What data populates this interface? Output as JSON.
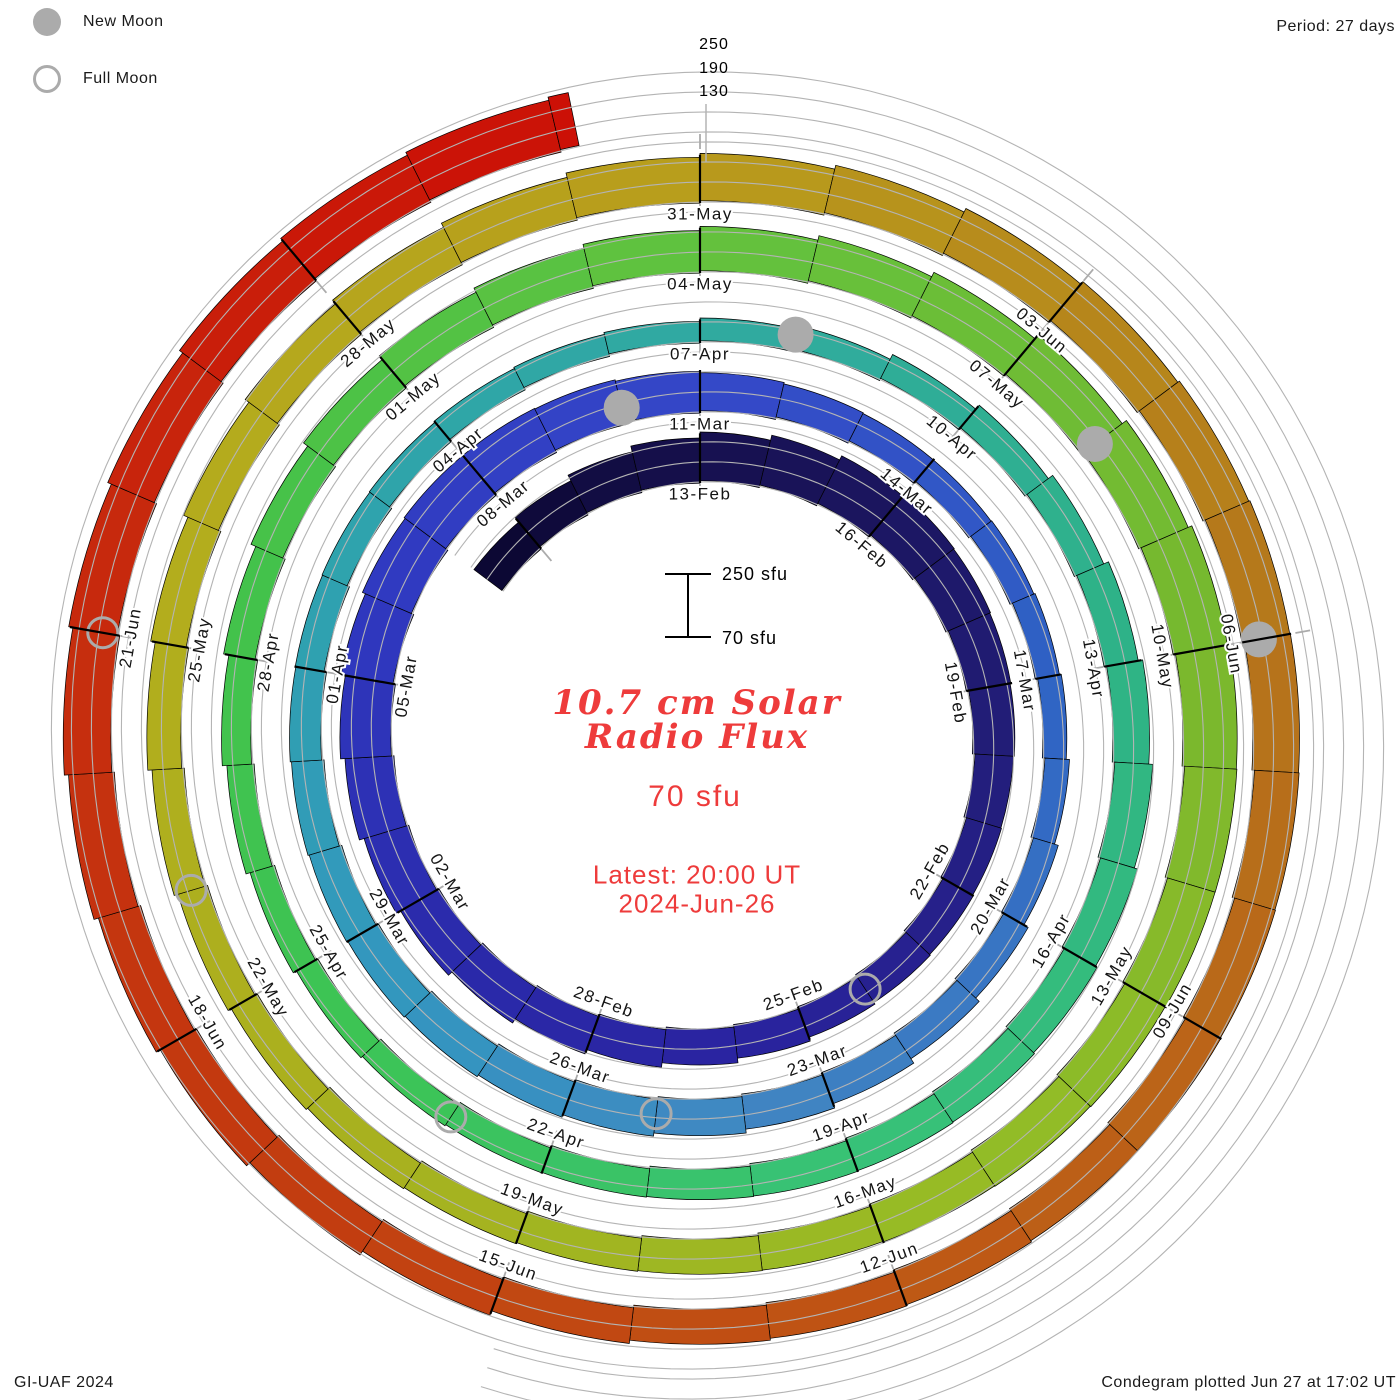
{
  "header": {
    "period_label": "Period: 27 days",
    "legend": [
      {
        "label": "New Moon",
        "type": "filled"
      },
      {
        "label": "Full Moon",
        "type": "open"
      }
    ]
  },
  "footer": {
    "left": "GI-UAF 2024",
    "right": "Condegram plotted Jun 27 at 17:02 UT"
  },
  "center_text": {
    "title_line1": "10.7 cm Solar",
    "title_line2": "Radio Flux",
    "baseline_label": "70 sfu",
    "latest_line1": "Latest: 20:00 UT",
    "latest_line2": "2024-Jun-26",
    "scale_top_label": "250 sfu",
    "scale_bottom_label": "70 sfu"
  },
  "radial_axis": {
    "labels": [
      "250",
      "190",
      "130"
    ]
  },
  "colors": {
    "accent_red": "#ee3b3b",
    "moon_gray": "#ababab",
    "gridline_gray": "#b4b4b4",
    "label_dark": "#141414"
  },
  "chart_data": {
    "type": "spiral_bar",
    "title": "10.7 cm Solar Radio Flux (Condegram)",
    "units": "sfu",
    "baseline_sfu": 70,
    "gridline_sfu": [
      130,
      190,
      250
    ],
    "period_days": 27,
    "angle_deg_per_day": 13.3333,
    "series_start_date": "2024-Feb-09",
    "label_start_date": "2024-Feb-13",
    "latest": "2024-Jun-26 20:00 UT",
    "flux_d_offset": -4,
    "flux": [
      175,
      185,
      196,
      206,
      216,
      224,
      230,
      226,
      216,
      206,
      196,
      186,
      180,
      175,
      170,
      168,
      172,
      178,
      184,
      190,
      197,
      203,
      210,
      217,
      223,
      228,
      230,
      226,
      218,
      208,
      196,
      184,
      172,
      162,
      154,
      148,
      144,
      142,
      144,
      148,
      155,
      162,
      170,
      176,
      180,
      182,
      182,
      180,
      176,
      172,
      168,
      164,
      158,
      152,
      146,
      142,
      138,
      136,
      138,
      142,
      150,
      158,
      166,
      174,
      180,
      184,
      186,
      184,
      180,
      174,
      168,
      162,
      156,
      150,
      146,
      144,
      147,
      152,
      158,
      166,
      174,
      182,
      188,
      194,
      198,
      203,
      209,
      216,
      224,
      232,
      236,
      233,
      227,
      219,
      210,
      200,
      191,
      182,
      176,
      170,
      166,
      162,
      160,
      163,
      167,
      172,
      178,
      184,
      190,
      196,
      202,
      208,
      212,
      216,
      220,
      222,
      220,
      216,
      210,
      204,
      198,
      192,
      186,
      182,
      178,
      176,
      178,
      184,
      190,
      196,
      202,
      208,
      213,
      218,
      222,
      226,
      228,
      230,
      232
    ],
    "date_labels": [
      {
        "d": 0,
        "label": "13-Feb"
      },
      {
        "d": 3,
        "label": "16-Feb"
      },
      {
        "d": 6,
        "label": "19-Feb"
      },
      {
        "d": 9,
        "label": "22-Feb"
      },
      {
        "d": 12,
        "label": "25-Feb"
      },
      {
        "d": 15,
        "label": "28-Feb"
      },
      {
        "d": 18,
        "label": "02-Mar"
      },
      {
        "d": 21,
        "label": "05-Mar"
      },
      {
        "d": 24,
        "label": "08-Mar"
      },
      {
        "d": 27,
        "label": "11-Mar"
      },
      {
        "d": 30,
        "label": "14-Mar"
      },
      {
        "d": 33,
        "label": "17-Mar"
      },
      {
        "d": 36,
        "label": "20-Mar"
      },
      {
        "d": 39,
        "label": "23-Mar"
      },
      {
        "d": 42,
        "label": "26-Mar"
      },
      {
        "d": 45,
        "label": "29-Mar"
      },
      {
        "d": 48,
        "label": "01-Apr"
      },
      {
        "d": 51,
        "label": "04-Apr"
      },
      {
        "d": 54,
        "label": "07-Apr"
      },
      {
        "d": 57,
        "label": "10-Apr"
      },
      {
        "d": 60,
        "label": "13-Apr"
      },
      {
        "d": 63,
        "label": "16-Apr"
      },
      {
        "d": 66,
        "label": "19-Apr"
      },
      {
        "d": 69,
        "label": "22-Apr"
      },
      {
        "d": 72,
        "label": "25-Apr"
      },
      {
        "d": 75,
        "label": "28-Apr"
      },
      {
        "d": 78,
        "label": "01-May"
      },
      {
        "d": 81,
        "label": "04-May"
      },
      {
        "d": 84,
        "label": "07-May"
      },
      {
        "d": 87,
        "label": "10-May"
      },
      {
        "d": 90,
        "label": "13-May"
      },
      {
        "d": 93,
        "label": "16-May"
      },
      {
        "d": 96,
        "label": "19-May"
      },
      {
        "d": 99,
        "label": "22-May"
      },
      {
        "d": 102,
        "label": "25-May"
      },
      {
        "d": 105,
        "label": "28-May"
      },
      {
        "d": 108,
        "label": "31-May"
      },
      {
        "d": 111,
        "label": "03-Jun"
      },
      {
        "d": 114,
        "label": "06-Jun"
      },
      {
        "d": 117,
        "label": "09-Jun"
      },
      {
        "d": 120,
        "label": "12-Jun"
      },
      {
        "d": 123,
        "label": "15-Jun"
      },
      {
        "d": 126,
        "label": "18-Jun"
      },
      {
        "d": 129,
        "label": "21-Jun"
      }
    ],
    "moons": {
      "new_moon": {
        "dates": [
          "10-Mar",
          "08-Apr",
          "08-May",
          "06-Jun"
        ],
        "d": [
          26,
          55,
          85,
          114
        ]
      },
      "full_moon": {
        "dates": [
          "24-Feb",
          "25-Mar",
          "23-Apr",
          "23-May",
          "21-Jun"
        ],
        "d": [
          11,
          41,
          70,
          100,
          129
        ]
      }
    },
    "colormap": [
      [
        -4,
        "#0b0730"
      ],
      [
        0,
        "#16104e"
      ],
      [
        6,
        "#211c74"
      ],
      [
        13,
        "#2a23a0"
      ],
      [
        17,
        "#2a2aaa"
      ],
      [
        22,
        "#3038c0"
      ],
      [
        27,
        "#3447c8"
      ],
      [
        33,
        "#2f62c4"
      ],
      [
        40,
        "#4187c2"
      ],
      [
        44,
        "#3396c0"
      ],
      [
        49,
        "#2fa2ae"
      ],
      [
        55,
        "#30ab9e"
      ],
      [
        60,
        "#2eb386"
      ],
      [
        66,
        "#38c277"
      ],
      [
        71,
        "#3cc455"
      ],
      [
        76,
        "#44c24a"
      ],
      [
        81,
        "#62c23e"
      ],
      [
        87,
        "#78b82e"
      ],
      [
        92,
        "#95bc26"
      ],
      [
        98,
        "#aab01e"
      ],
      [
        103,
        "#b4ad1d"
      ],
      [
        108,
        "#b89c1c"
      ],
      [
        114,
        "#b5761b"
      ],
      [
        119,
        "#bd5c16"
      ],
      [
        124,
        "#c23f10"
      ],
      [
        129,
        "#c62c0e"
      ],
      [
        134,
        "#cc1006"
      ]
    ]
  }
}
